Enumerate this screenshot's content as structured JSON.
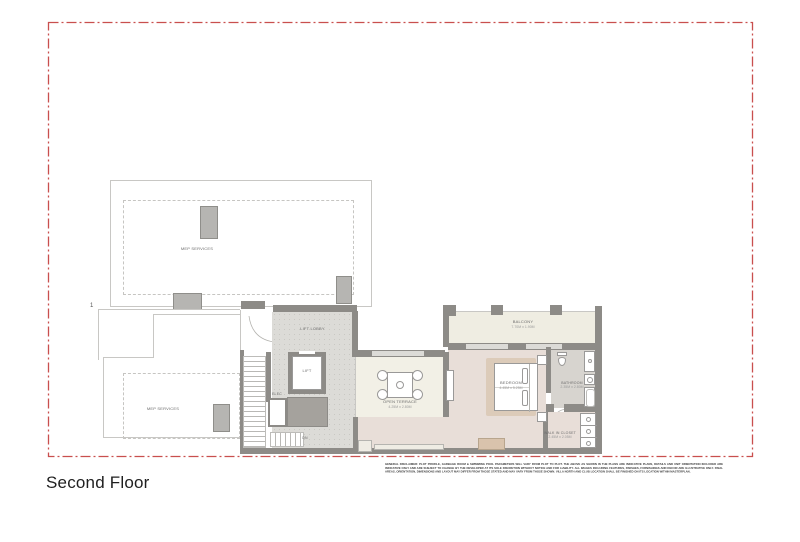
{
  "page": {
    "title": "Second Floor"
  },
  "plan": {
    "marker": "1",
    "rooms": {
      "mep_upper": {
        "label": "MEP SERVICES"
      },
      "mep_lower": {
        "label": "MEP SERVICES"
      },
      "lift_lobby": {
        "label": "LIFT LOBBY"
      },
      "lift": {
        "label": "LIFT"
      },
      "elec": {
        "label": "ELEC"
      },
      "stairs": {
        "label": "DN"
      },
      "open_terrace": {
        "label": "OPEN TERRACE",
        "dimensions": "4.25M x 2.80M"
      },
      "balcony": {
        "label": "BALCONY",
        "dimensions": "7.70M x 1.90M"
      },
      "bedroom": {
        "label": "BEDROOM",
        "dimensions": "4.45M x 5.25M"
      },
      "bathroom": {
        "label": "BATHROOM",
        "dimensions": "2.35M x 2.80M"
      },
      "walk_in_closet": {
        "label": "WALK IN CLOSET",
        "dimensions": "2.45M x 2.05M"
      }
    }
  },
  "disclaimer": "GENERAL DISCLAIMER: PLOT PROFILE, GARBAGE ROOM & SWIMMING POOL PARAMETERS WILL VARY FROM PLOT TO PLOT. THE ABOVE AS SHOWN IN THE PLANS ARE INDICATIVE PLANS, DETAILS AND UNIT ORIENTATION INCLUDED ARE INDICATIVE ONLY AND ARE SUBJECT TO CHANGE BY THE DEVELOPER AT ITS SOLE DISCRETION WITHOUT NOTICE AND FOR LIABILITY. ALL IMAGES INCLUDING FEATURES, FINISHES, FURNISHINGS AND DECOR ARE ILLUSTRATIVE ONLY. FINAL AREAS, ORIENTATION, DIMENSIONS AND LAYOUT MAY DIFFER FROM THOSE STATED AND MAY VARY FROM THOSE SHOWN. VILLA NORTH AND CLUB LOCATION SHALL BE FINISHED ON ITS LOCATION WITHIN MASTERPLAN.",
  "colors": {
    "plot_boundary_red": "#c94f4e",
    "wall_gray": "#8d8b87",
    "interior_floor": "#e8ded8",
    "terrace_floor": "#f2f0e6",
    "balcony_floor": "#efede2",
    "lobby_floor": "#dcdbd7"
  }
}
